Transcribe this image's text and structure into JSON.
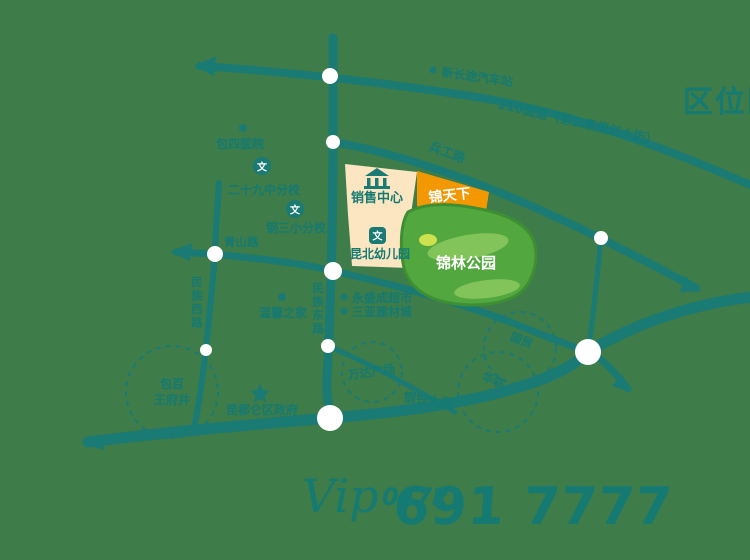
{
  "title": "区位图",
  "colors": {
    "background": "#3E7C49",
    "road_teal": "#1A7A74",
    "text_teal": "#157A72",
    "parcel_cream": "#FCE5C1",
    "parcel_orange": "#F39800",
    "park_green": "#52A83E",
    "park_light": "#82C45A",
    "park_yellow": "#CDE04E",
    "white": "#FFFFFF"
  },
  "roads": {
    "guodao110": "110国道（第二条规划大街）",
    "binggong": "兵工路",
    "minzu_east": "民族东路",
    "minzu_west": "民族西路",
    "qingshan": "青山路",
    "gangtie": "钢铁大街"
  },
  "areas": {
    "sales_center": "销售中心",
    "project": "锦天下",
    "kindergarten": "昆北幼儿园",
    "park": "锦林公园"
  },
  "pois": {
    "bus_station": "新长途汽车站",
    "hospital": "包四医院",
    "school_29": "二十九中分校",
    "school_g3": "钢三小分校",
    "wenxin_home": "温馨之家",
    "supermarket": "永盛成超市",
    "building_material": "三亚建材城",
    "wanda": "万达广场",
    "district_gov": "昆都仑区政府",
    "baobai": "包百",
    "wangfujing": "王府井",
    "guomao": "国贸",
    "hualian": "华联"
  },
  "icons": {
    "wen": "文"
  },
  "phone": {
    "script_logo": "Vip",
    "area_code": "0472",
    "number": "691 7777"
  }
}
